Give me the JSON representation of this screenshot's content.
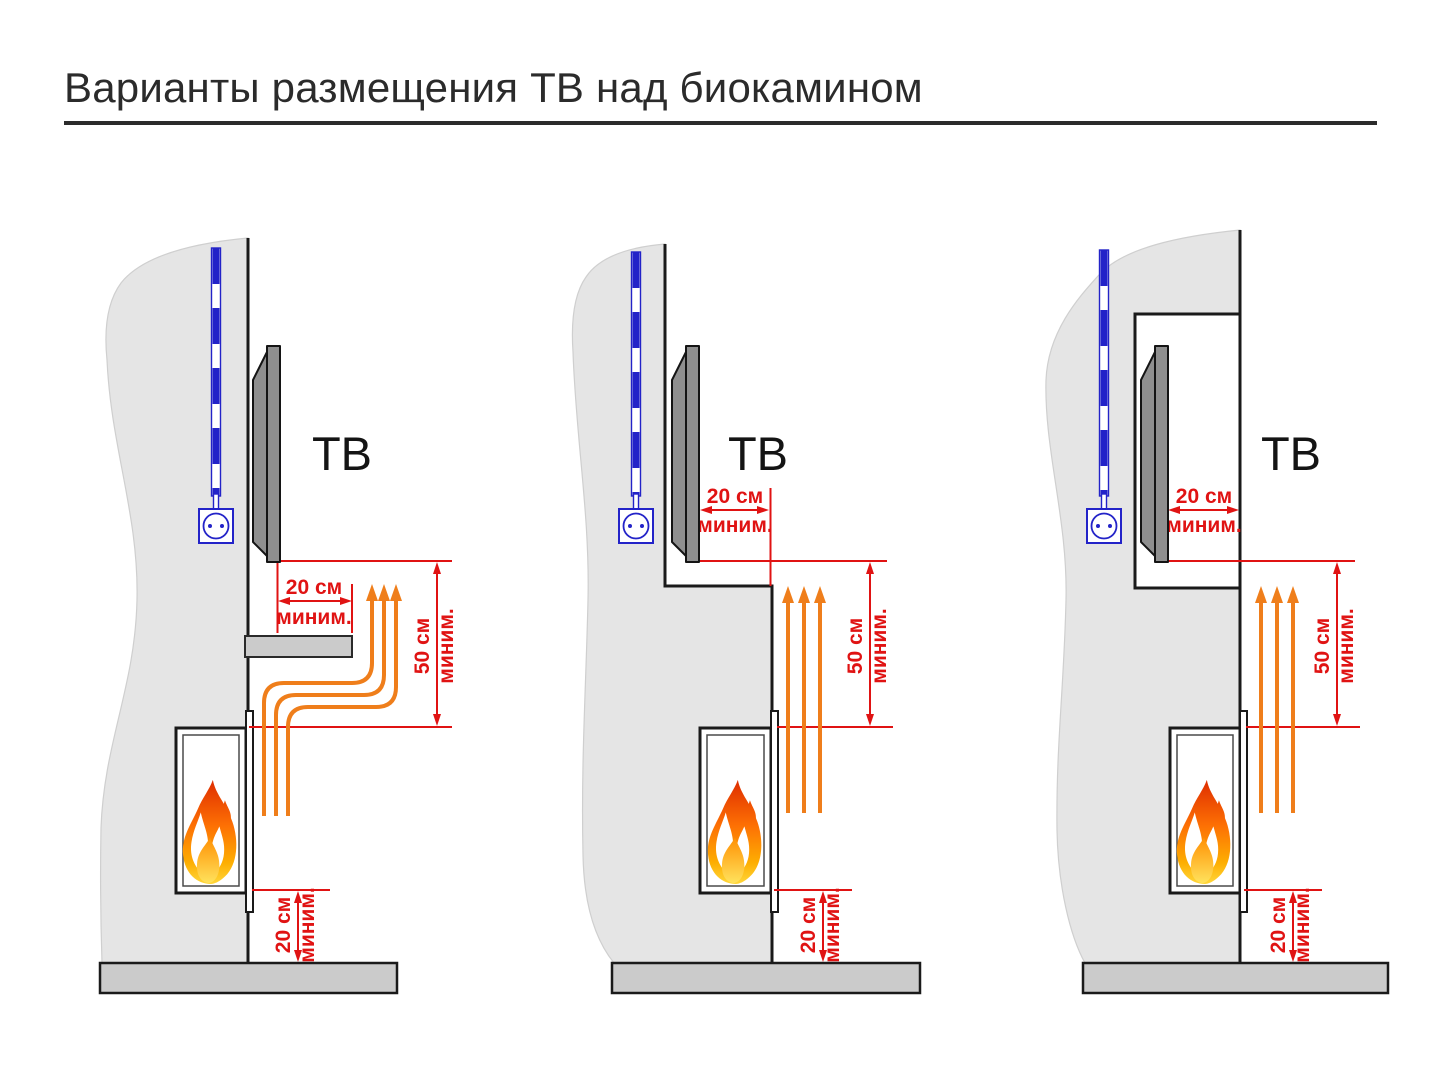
{
  "title": "Варианты размещения ТВ над биокамином",
  "variants": [
    {
      "tv": "ТВ",
      "tv_clearance": {
        "value": "20 см",
        "note": "миним."
      },
      "heat_clearance": {
        "value": "50 см",
        "note": "миним."
      },
      "floor_clearance": {
        "value": "20 см",
        "note": "миним."
      }
    },
    {
      "tv": "ТВ",
      "tv_clearance": {
        "value": "20 см",
        "note": "миним."
      },
      "heat_clearance": {
        "value": "50 см",
        "note": "миним."
      },
      "floor_clearance": {
        "value": "20 см",
        "note": "миним."
      }
    },
    {
      "tv": "ТВ",
      "tv_clearance": {
        "value": "20 см",
        "note": "миним."
      },
      "heat_clearance": {
        "value": "50 см",
        "note": "миним."
      },
      "floor_clearance": {
        "value": "20 см",
        "note": "миним."
      }
    }
  ],
  "colors": {
    "dimension_red": "#e01313",
    "heat_orange": "#ef7e1b",
    "cable_blue": "#2323c8",
    "wall_gray": "#e5e5e5",
    "floor_gray": "#cbcbcb",
    "tv_gray": "#8f8f8f",
    "outline_dark": "#1a1a1a"
  }
}
